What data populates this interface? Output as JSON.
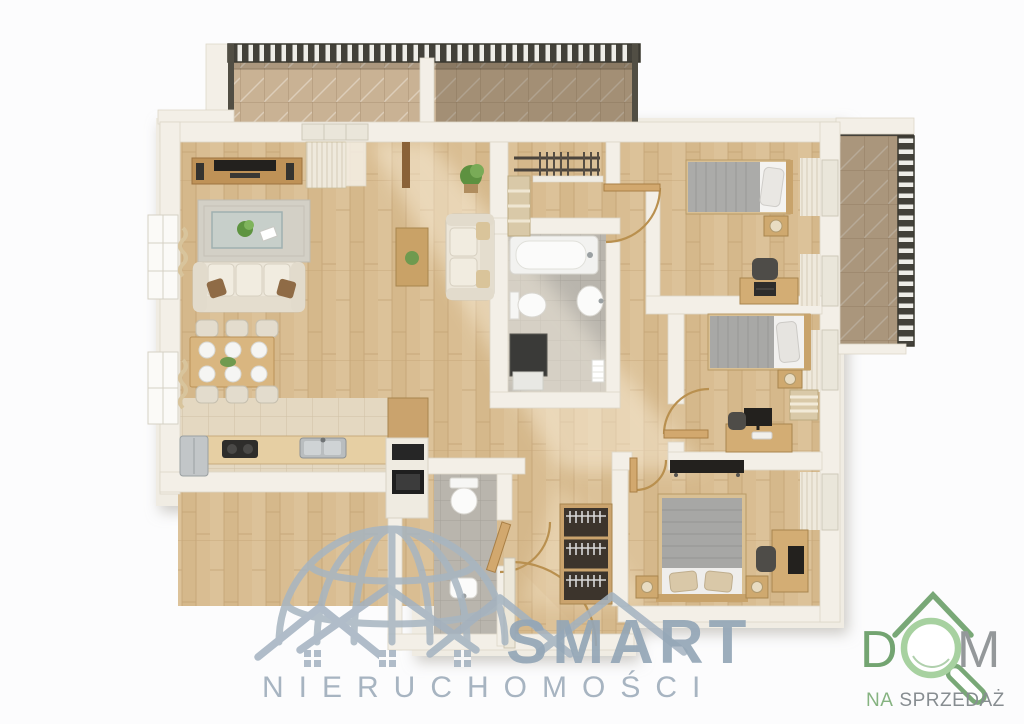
{
  "watermarks": {
    "smart": {
      "title": "SMART",
      "subtitle": "NIERUCHOMOŚCI",
      "color": "#9db0bf"
    },
    "dom": {
      "letter_d": "D",
      "letter_m": "M",
      "tagline_left": "NA",
      "tagline_right": "SPRZEDAŻ",
      "green_dark": "#74a572",
      "green_light": "#a8d2a2",
      "gray": "#96999b"
    }
  },
  "floorplan": {
    "type": "apartment-top-view-3d-render",
    "colors": {
      "wall": "#f3efe7",
      "wood_floor": "#d8bd93",
      "tile_gray": "#b9b5ad",
      "tile_beige": "#e4d8c1",
      "balcony_deck": "#c9b294",
      "railing": "#43413a",
      "furniture_wood": "#d3ad74",
      "sofa_beige": "#ece6d9",
      "blanket_gray": "#a8a8a6"
    },
    "rooms": [
      {
        "name": "living-room",
        "furniture": [
          "tv-console",
          "speakers",
          "rug",
          "glass-coffee-table",
          "sofa-three-seat",
          "loveseat",
          "side-table",
          "potted-plant"
        ]
      },
      {
        "name": "dining-area",
        "furniture": [
          "dining-table",
          "chairs-x6",
          "plates-x6"
        ]
      },
      {
        "name": "kitchen",
        "furniture": [
          "fridge",
          "counter",
          "cooktop",
          "sink",
          "oven-column"
        ]
      },
      {
        "name": "bathroom",
        "furniture": [
          "bathtub",
          "toilet",
          "washbasin",
          "washing-machine",
          "towel"
        ]
      },
      {
        "name": "wc",
        "furniture": [
          "toilet",
          "washbasin"
        ]
      },
      {
        "name": "walk-in-closet",
        "furniture": [
          "hanging-rails",
          "shelves"
        ]
      },
      {
        "name": "hallway",
        "furniture": [
          "open-wardrobe",
          "entrance-door"
        ]
      },
      {
        "name": "bedroom-1",
        "furniture": [
          "single-bed",
          "nightstand",
          "lamp",
          "desk",
          "laptop",
          "chair",
          "curtains"
        ]
      },
      {
        "name": "bedroom-2",
        "furniture": [
          "single-bed",
          "nightstand",
          "lamp",
          "linen-shelf",
          "desk",
          "monitor",
          "chair",
          "curtains"
        ]
      },
      {
        "name": "bedroom-3-master",
        "furniture": [
          "double-bed",
          "nightstand-x2",
          "wall-tv",
          "desk",
          "monitor",
          "chair",
          "curtains"
        ]
      },
      {
        "name": "balcony-top",
        "furniture": [
          "deck",
          "railing"
        ]
      },
      {
        "name": "balcony-right",
        "furniture": [
          "deck",
          "railing"
        ]
      }
    ]
  }
}
